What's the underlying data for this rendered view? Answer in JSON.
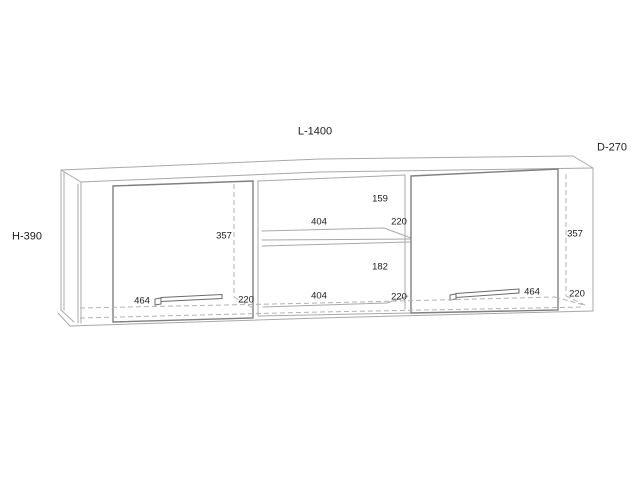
{
  "drawing": {
    "subject": "Wall-mounted cabinet technical drawing: two doors with long handles and an open center compartment with one shelf",
    "overall": {
      "length": "L-1400",
      "depth": "D-270",
      "height": "H-390"
    },
    "labels": {
      "left_door_height": "357",
      "right_door_height": "357",
      "upper_opening_height": "159",
      "upper_opening_width": "404",
      "upper_depth": "220",
      "lower_opening_height": "182",
      "lower_opening_width": "404",
      "lower_depth": "220",
      "left_handle_length": "464",
      "left_door_depth": "220",
      "right_handle_length": "464",
      "right_door_depth": "220"
    },
    "colors": {
      "background": "#ffffff",
      "carcass_line": "#a8a8a8",
      "door_line": "#7f7f7f",
      "text": "#1c1c1c"
    }
  }
}
